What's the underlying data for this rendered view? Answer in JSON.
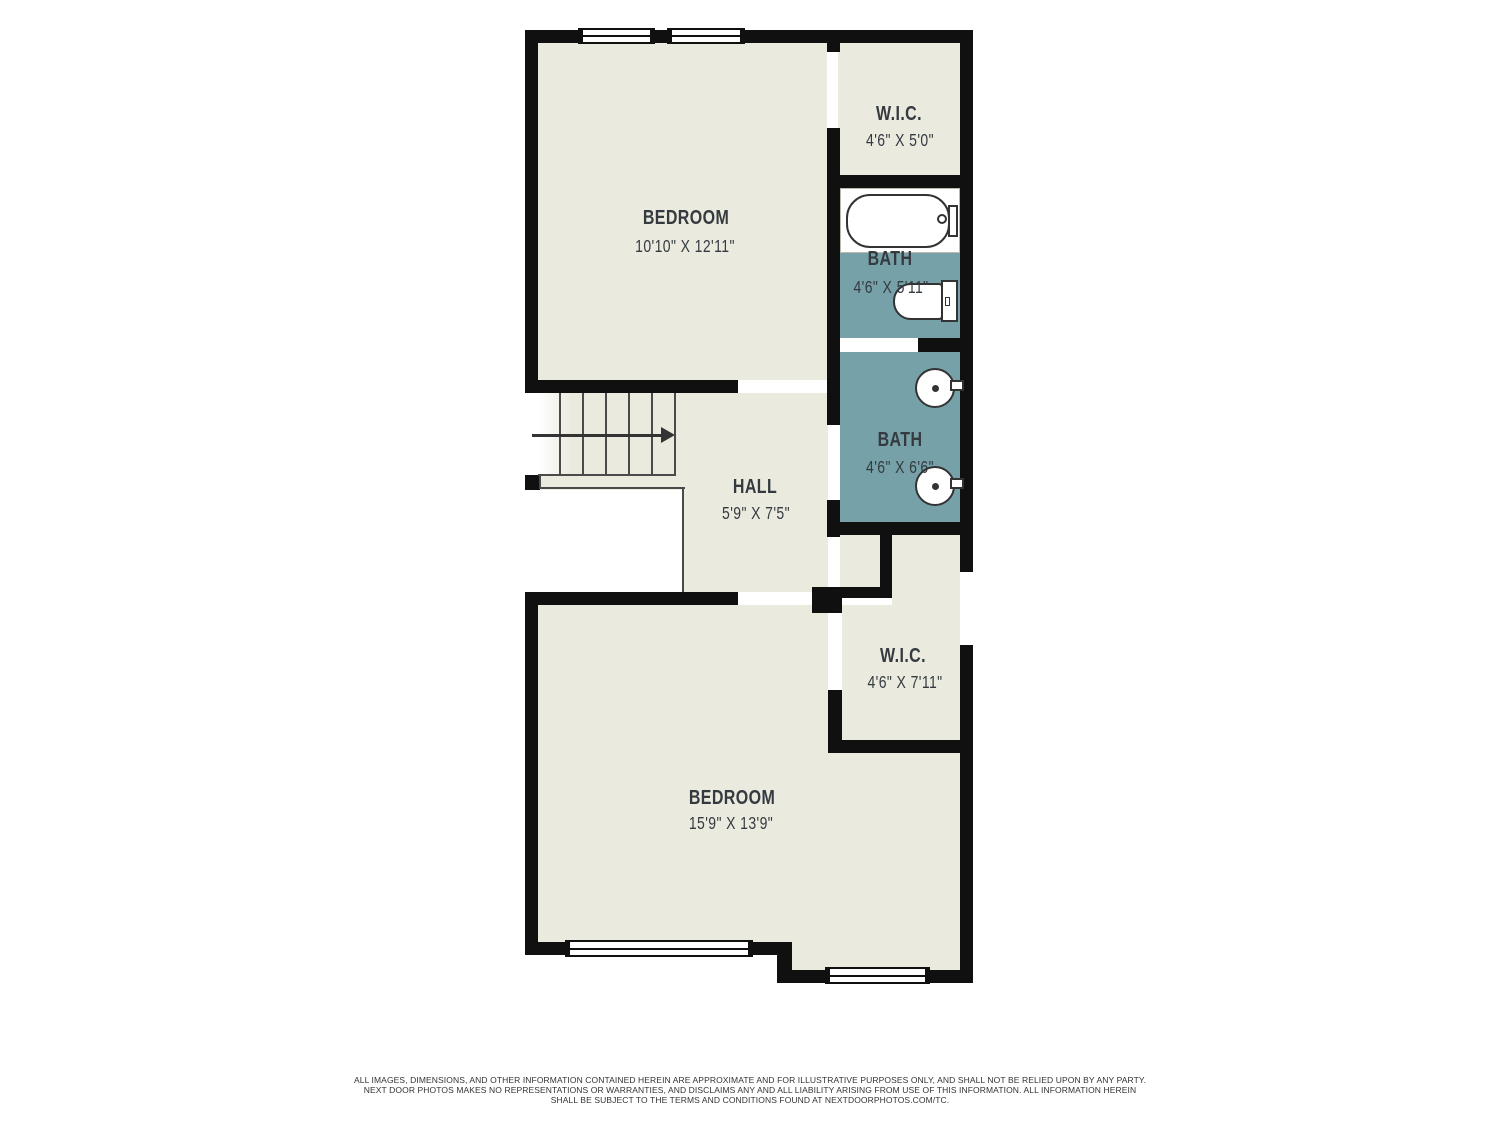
{
  "floorplan": {
    "rooms": {
      "bedroom1": {
        "name": "BEDROOM",
        "dims": "10'10\" X 12'11\""
      },
      "wic1": {
        "name": "W.I.C.",
        "dims": "4'6\" X 5'0\""
      },
      "bath1": {
        "name": "BATH",
        "dims": "4'6\" X 5'11\""
      },
      "bath2": {
        "name": "BATH",
        "dims": "4'6\" X 6'6\""
      },
      "hall": {
        "name": "HALL",
        "dims": "5'9\" X 7'5\""
      },
      "wic2": {
        "name": "W.I.C.",
        "dims": "4'6\" X 7'11\""
      },
      "bedroom2": {
        "name": "BEDROOM",
        "dims": "15'9\" X 13'9\""
      }
    },
    "fixtures": {
      "bath1": [
        "bathtub",
        "toilet"
      ],
      "bath2": [
        "pedestal-sink",
        "pedestal-sink"
      ],
      "hall": [
        "staircase",
        "direction-arrow-right"
      ]
    },
    "colors": {
      "background": "#FFFFFF",
      "floor": "#EBEADF",
      "bath_floor": "#76A1A8",
      "wall": "#101010",
      "fixture_outline": "#333333",
      "label_text": "#343A40"
    }
  },
  "disclaimer": {
    "line1": "ALL IMAGES, DIMENSIONS, AND OTHER INFORMATION CONTAINED HEREIN ARE APPROXIMATE AND FOR ILLUSTRATIVE PURPOSES ONLY, AND SHALL NOT BE RELIED UPON BY ANY PARTY.",
    "line2": "NEXT DOOR PHOTOS MAKES NO REPRESENTATIONS OR WARRANTIES, AND DISCLAIMS ANY AND ALL LIABILITY ARISING FROM USE OF THIS INFORMATION. ALL INFORMATION HEREIN",
    "line3": "SHALL BE SUBJECT TO THE TERMS AND CONDITIONS FOUND AT NEXTDOORPHOTOS.COM/TC."
  }
}
